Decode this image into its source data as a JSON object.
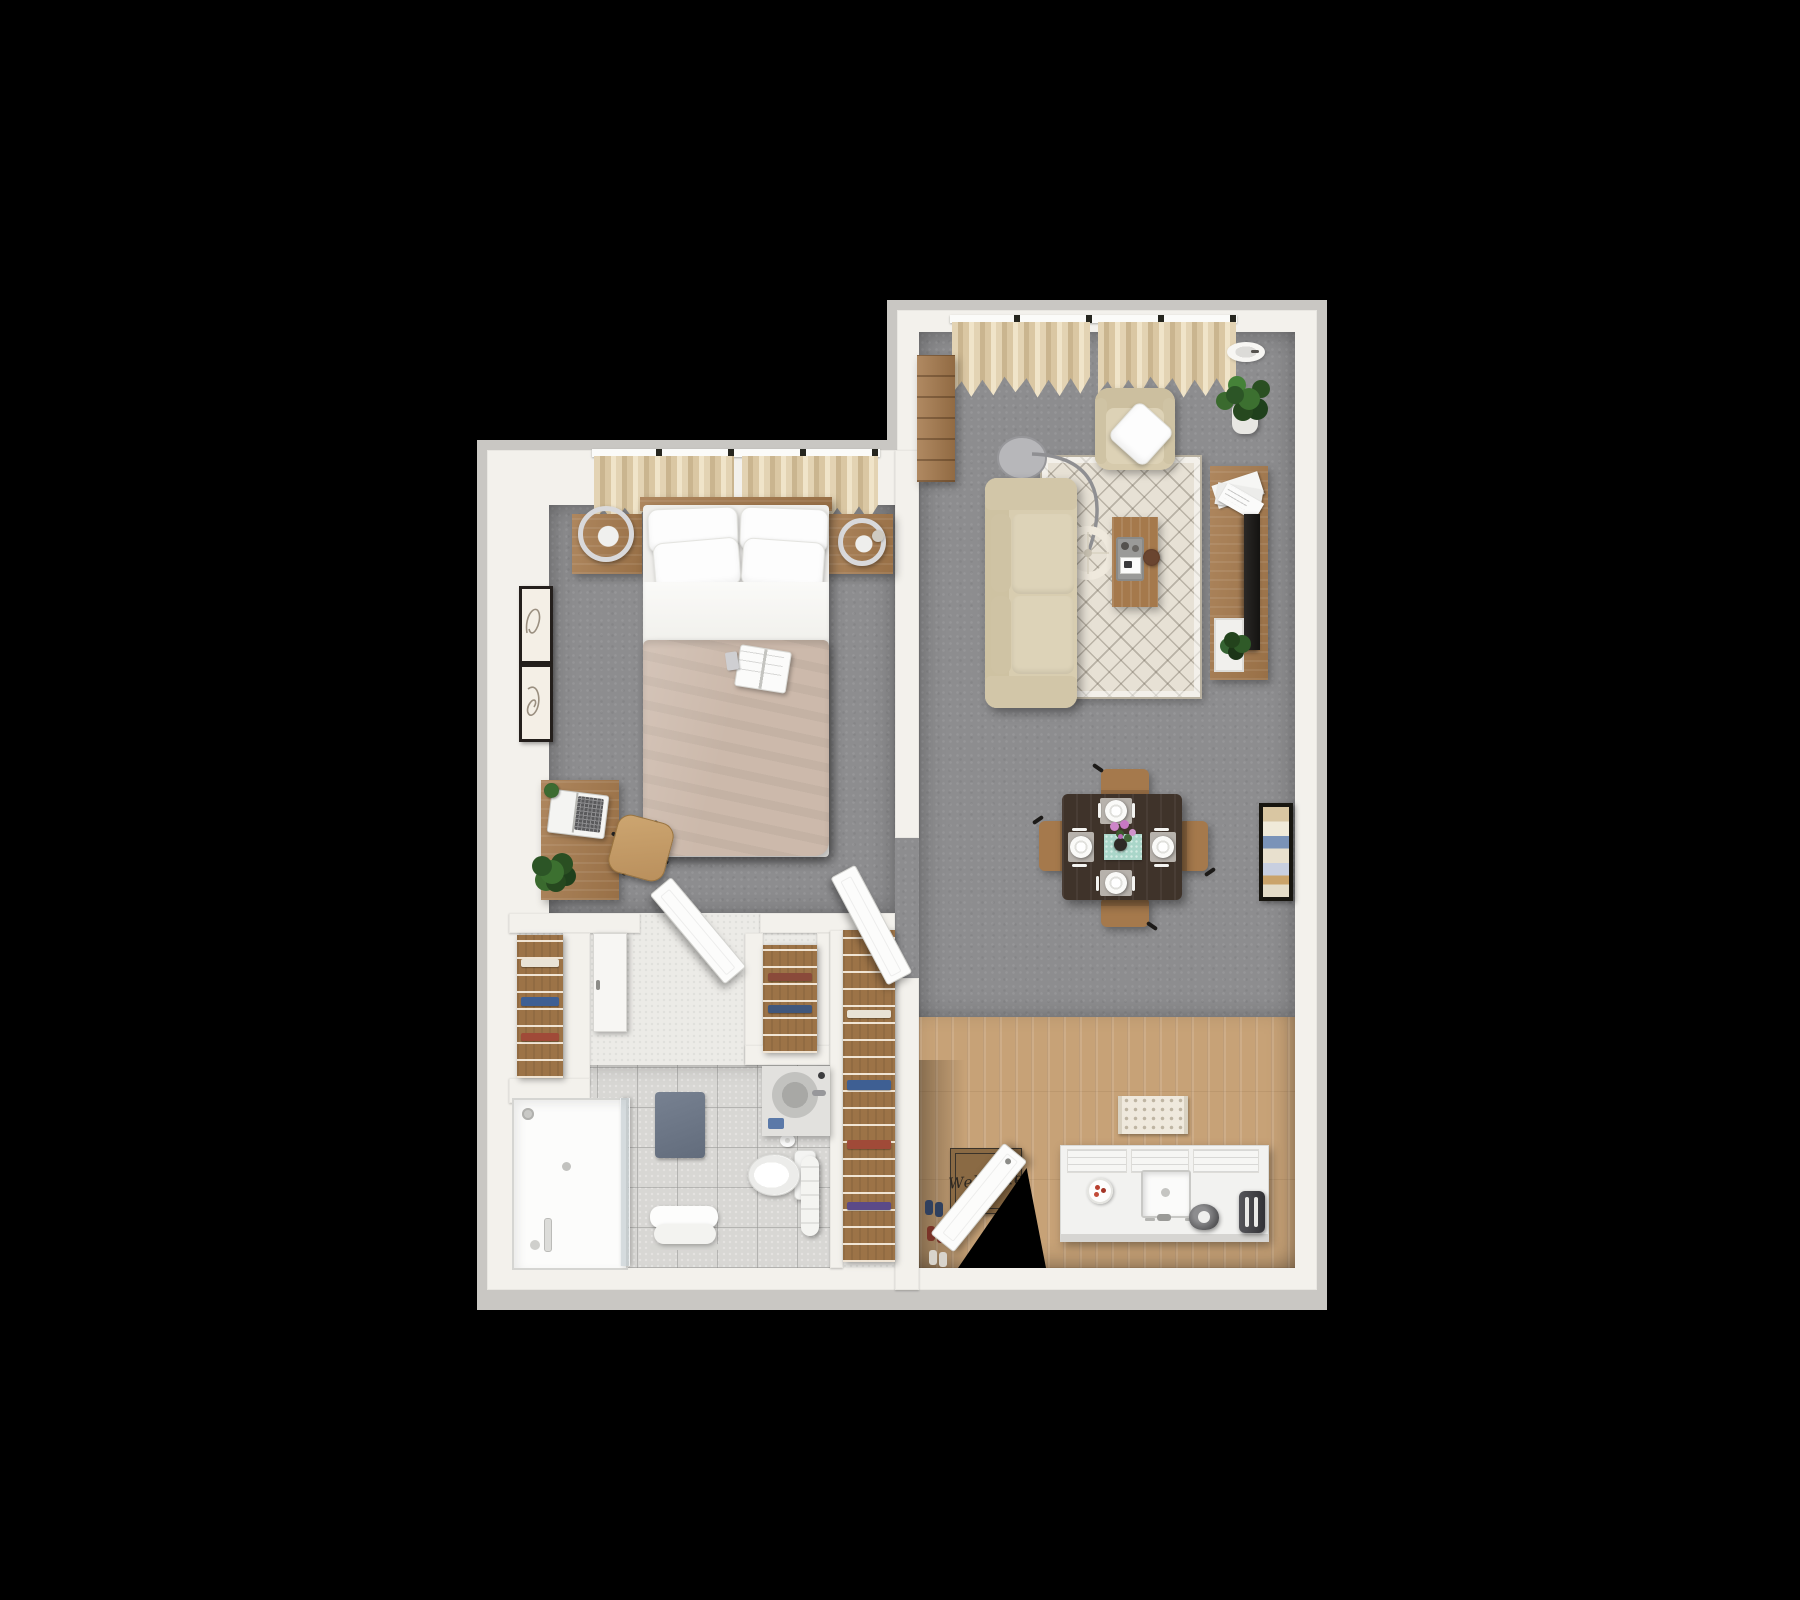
{
  "canvas": {
    "width": 1800,
    "height": 1600,
    "background": "#000000"
  },
  "palette": {
    "wall": "#f3f1ec",
    "walledge": "#c9c7c3",
    "carpet": "#8d8d8f",
    "woodfloor": "#c7a277",
    "tile": "#d8d7d4",
    "hallfloor": "#ecebe7",
    "woodfurn": "#a5794c",
    "woodshelf": "#9c7347",
    "sofa": "#d8cdb0",
    "duvet": "#ccb9ab",
    "curtain": "#dac7a3",
    "rugbase": "#e7e1d5",
    "plantgreen": "#38652c",
    "teal": "#a9d6c9",
    "pink": "#cd86c8",
    "diningtop": "#3f332a",
    "matbrown": "#8a6a44",
    "counter": "#f2f2f0"
  },
  "entry": {
    "mat_text": "Welcome"
  },
  "inventory": {
    "bedroom": [
      "window-curtains",
      "nightstand-left",
      "ring-lamp-left",
      "nightstand-right",
      "ring-lamp-right",
      "double-bed",
      "pillows",
      "top-sheet",
      "duvet",
      "book-on-bed",
      "wall-art-top",
      "wall-art-bottom",
      "desk",
      "laptop",
      "desk-plant-small",
      "floor-plant",
      "office-chair"
    ],
    "closets_hall": [
      "linen-closet-shelves",
      "white-wardrobe-door",
      "bathroom-door-open",
      "small-closet-shelves",
      "walk-in-closet-shelves",
      "bedroom-door-open"
    ],
    "bathroom": [
      "walk-in-shower",
      "shower-glass-panel",
      "shower-head",
      "floor-drain",
      "bath-mat",
      "bench-with-towel",
      "toilet",
      "toilet-paper-roll",
      "vanity-sink",
      "hand-towel",
      "towel-stack"
    ],
    "living_room": [
      "window-curtains",
      "recessed-ceiling-light",
      "tall-dresser",
      "armchair",
      "throw-pillow",
      "potted-plant",
      "arc-floor-lamp",
      "sofa",
      "area-rug",
      "coffee-table",
      "serving-tray",
      "wood-bowl",
      "tv-console",
      "magazine-stack",
      "television",
      "console-plant",
      "wall-art-frame"
    ],
    "dining_area": [
      "dining-table",
      "table-runner",
      "flower-vase",
      "dinner-plates",
      "cutlery",
      "dining-chairs"
    ],
    "kitchen_entry": [
      "wood-flooring",
      "kitchen-rug",
      "kitchen-counter",
      "sink",
      "faucet",
      "snack-plate",
      "kettle",
      "toaster",
      "welcome-mat",
      "entry-door-open",
      "doorway-void",
      "entry-shoes"
    ]
  }
}
